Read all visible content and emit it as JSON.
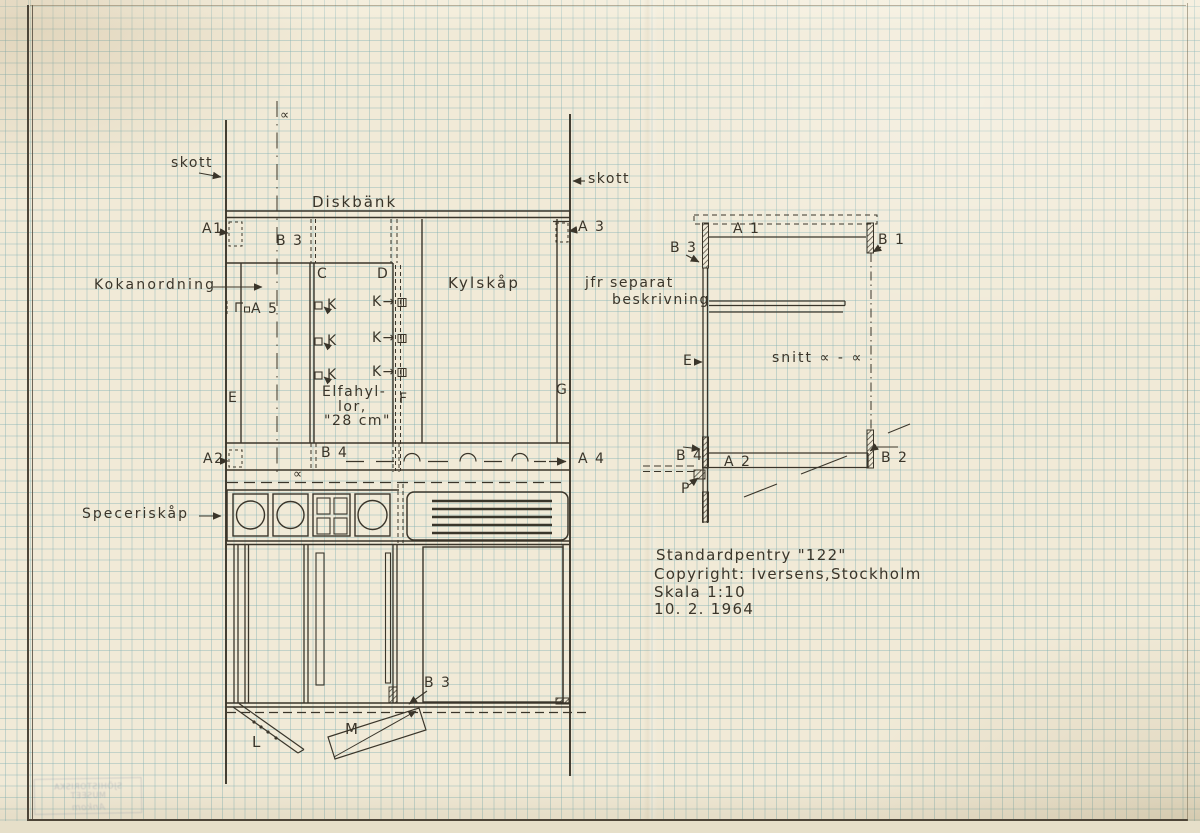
{
  "plan": {
    "alpha_section_top": "∝",
    "alpha_section_mid": "∝",
    "skott_left": "skott",
    "skott_right": "skott",
    "diskbank": "Diskbänk",
    "a1": "A1",
    "a3": "A 3",
    "b3": "B 3",
    "kokanordning": "Kokanordning",
    "a5": "A 5",
    "c": "C",
    "d": "D",
    "kylskap": "Kylskåp",
    "k_marks": [
      "K",
      "K",
      "K"
    ],
    "k_socket": [
      "K→",
      "K→",
      "K→"
    ],
    "elfa_line1": "Elfahyl-",
    "elfa_line2": "lor,",
    "elfa_line3": "\"28 cm\"",
    "e": "E",
    "f": "F",
    "g": "G",
    "a2": "A2",
    "b4": "B 4",
    "a4": "A 4",
    "speceriskap": "Speceriskåp",
    "b3_front": "B 3",
    "l": "L",
    "m": "M"
  },
  "section": {
    "a1": "A 1",
    "b1": "B 1",
    "b3": "B 3",
    "note_line1": "jfr separat",
    "note_line2": "beskrivning",
    "e": "E",
    "snitt": "snitt ∝ - ∝",
    "b4": "B 4",
    "a2": "A 2",
    "b2": "B 2",
    "p": "P"
  },
  "title_block": {
    "line1": "Standardpentry \"122\"",
    "line2": "Copyright: Iversens,Stockholm",
    "line3": "Skala 1:10",
    "line4": "10. 2. 1964"
  },
  "stamp": {
    "line1": "SJÖHISTORISKA MUSEET",
    "line2": "Ankom"
  },
  "colors": {
    "ink": "#3a352a",
    "paper": "#f1ead7",
    "grid": "#7daFb2"
  }
}
